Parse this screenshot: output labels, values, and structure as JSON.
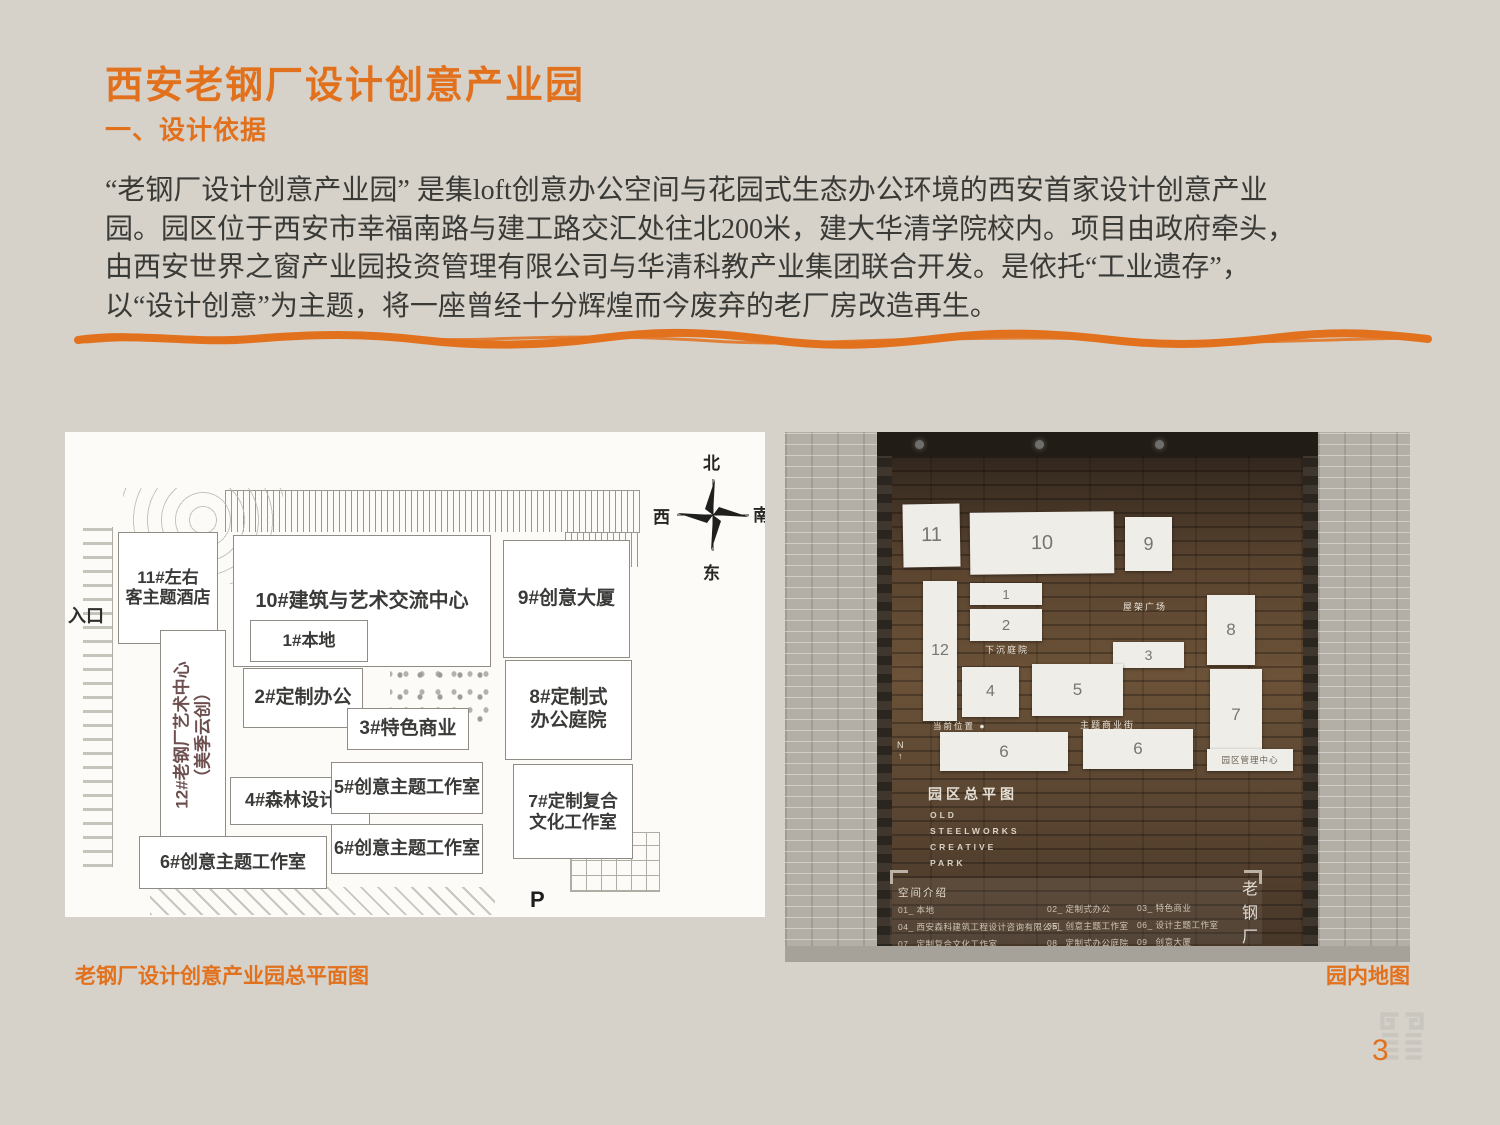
{
  "colors": {
    "accent": "#e2711d",
    "background": "#d6d2ca",
    "body_text": "#3a3a37"
  },
  "header": {
    "title": "西安老钢厂设计创意产业园",
    "subtitle": "一、设计依据"
  },
  "intro": {
    "lines": [
      "“老钢厂设计创意产业园” 是集loft创意办公空间与花园式生态办公环境的西安首家设计创意产业",
      "园。园区位于西安市幸福南路与建工路交汇处往北200米，建大华清学院校内。项目由政府牵头，",
      "由西安世界之窗产业园投资管理有限公司与华清科教产业集团联合开发。是依托“工业遗存”，",
      "以“设计创意”为主题，将一座曾经十分辉煌而今废弃的老厂房改造再生。"
    ]
  },
  "site_plan": {
    "caption": "老钢厂设计创意产业园总平面图",
    "entrance_label": "入口",
    "parking_label": "P",
    "compass": {
      "north": "北",
      "west": "西",
      "south": "南",
      "east": "东"
    },
    "buildings": {
      "b11": "11#左右\n客主题酒店",
      "b10": "10#建筑与艺术交流中心",
      "b9": "9#创意大厦",
      "b1": "1#本地",
      "b2": "2#定制办公",
      "b3": "3#特色商业",
      "b8": "8#定制式\n办公庭院",
      "b4": "4#森林设计院",
      "b5": "5#创意主题工作室",
      "b7": "7#定制复合\n文化工作室",
      "b6a": "6#创意主题工作室",
      "b6b": "6#创意主题工作室",
      "b12_line1": "12#老钢厂艺术中心",
      "b12_line2": "（美季云创）"
    }
  },
  "wall_map": {
    "caption": "园内地图",
    "panels": {
      "p11": "11",
      "p10": "10",
      "p9": "9",
      "p1": "1",
      "p2": "2",
      "p12": "12",
      "p8": "8",
      "p3": "3",
      "p4": "4",
      "p5": "5",
      "p7": "7",
      "p6a": "6",
      "p6b": "6",
      "management": "园区管理中心"
    },
    "labels": {
      "roof_plaza": "屋架广场",
      "sunken_court": "下沉庭院",
      "current_location": "当前位置 ●",
      "commercial_street": "主题商业街",
      "north": "N",
      "north_arrow": "↑"
    },
    "sign": {
      "title_cn": "园区总平图",
      "en1": "OLD",
      "en2": "STEELWORKS",
      "en3": "CREATIVE",
      "en4": "PARK"
    },
    "legend": {
      "title": "空间介绍",
      "col1": [
        "01_ 本地",
        "04_ 西安森科建筑工程设计咨询有限公司",
        "07_ 定制复合文化工作室"
      ],
      "col2": [
        "02_ 定制式办公",
        "05_ 创意主题工作室",
        "08_ 定制式办公庭院"
      ],
      "col3": [
        "03_ 特色商业",
        "06_ 设计主题工作室",
        "09_ 创意大厦"
      ]
    },
    "vertical_sign": "老钢厂"
  },
  "footer": {
    "page_number": "3"
  }
}
